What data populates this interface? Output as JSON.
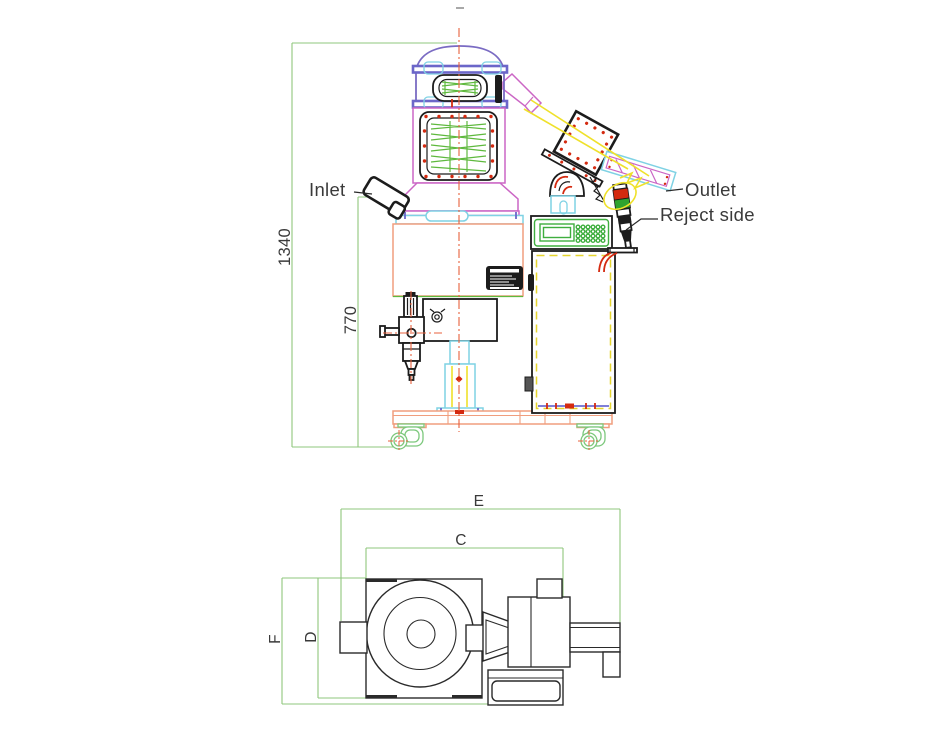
{
  "side_view": {
    "labels": {
      "inlet": "Inlet",
      "outlet": "Outlet",
      "reject_side": "Reject side"
    },
    "dimensions": {
      "overall_height": "1340",
      "inlet_height": "770"
    }
  },
  "plan_view": {
    "dimensions": {
      "overall_width": "E",
      "body_width": "C",
      "overall_depth": "F",
      "body_depth": "D"
    }
  },
  "colors": {
    "dimension_line_green": "#8fc77c",
    "frame_salmon": "#f09e7e",
    "housing_magenta": "#cb66c5",
    "dome_purple": "#7a6bc3",
    "clamp_band_blue": "#6b66c9",
    "pipe_cyan": "#7fd2e4",
    "coil_green": "#5fb93e",
    "panel_green": "#3fae3f",
    "chute_yellow": "#efe12b",
    "centerline_orange": "#e8603c",
    "bolt_red": "#d42a10",
    "tower_light_red": "#d42a10",
    "tower_light_green": "#2fa32f",
    "line_black": "#1c1c1c",
    "label_text": "#3a3a3a"
  }
}
